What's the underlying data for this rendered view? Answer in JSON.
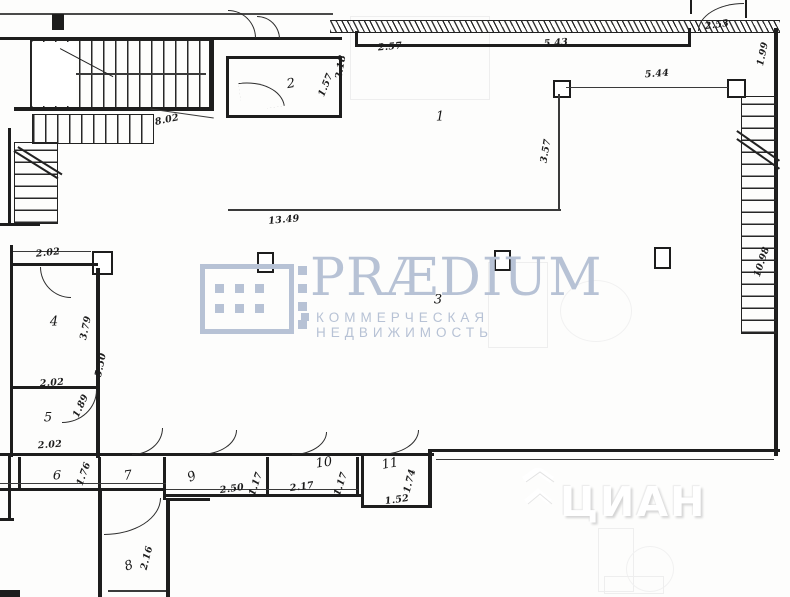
{
  "plan": {
    "rooms": [
      {
        "n": "1",
        "x": 440,
        "y": 117,
        "rot": 0
      },
      {
        "n": "2",
        "x": 291,
        "y": 84,
        "rot": -10
      },
      {
        "n": "3",
        "x": 438,
        "y": 300,
        "rot": 0
      },
      {
        "n": "4",
        "x": 54,
        "y": 322,
        "rot": 0
      },
      {
        "n": "5",
        "x": 48,
        "y": 418,
        "rot": 0
      },
      {
        "n": "6",
        "x": 57,
        "y": 476,
        "rot": 0
      },
      {
        "n": "7",
        "x": 128,
        "y": 476,
        "rot": -8
      },
      {
        "n": "8",
        "x": 129,
        "y": 566,
        "rot": -20
      },
      {
        "n": "9",
        "x": 192,
        "y": 477,
        "rot": -25
      },
      {
        "n": "10",
        "x": 324,
        "y": 463,
        "rot": -8
      },
      {
        "n": "11",
        "x": 390,
        "y": 464,
        "rot": -10
      }
    ],
    "dims": [
      {
        "v": "2.57",
        "x": 390,
        "y": 47,
        "rot": -5
      },
      {
        "v": "5.43",
        "x": 556,
        "y": 43,
        "rot": -4
      },
      {
        "v": "2.53",
        "x": 717,
        "y": 25,
        "rot": -8
      },
      {
        "v": "1.99",
        "x": 763,
        "y": 54,
        "rot": -78
      },
      {
        "v": "5.44",
        "x": 657,
        "y": 74,
        "rot": -4
      },
      {
        "v": "2.18",
        "x": 341,
        "y": 67,
        "rot": -80
      },
      {
        "v": "1.57",
        "x": 326,
        "y": 85,
        "rot": -68
      },
      {
        "v": "8.02",
        "x": 167,
        "y": 120,
        "rot": -12
      },
      {
        "v": "3.57",
        "x": 546,
        "y": 151,
        "rot": -80
      },
      {
        "v": "13.49",
        "x": 284,
        "y": 220,
        "rot": -5
      },
      {
        "v": "10.98",
        "x": 762,
        "y": 262,
        "rot": -72
      },
      {
        "v": "2.02",
        "x": 48,
        "y": 253,
        "rot": -6
      },
      {
        "v": "3.79",
        "x": 86,
        "y": 328,
        "rot": -78
      },
      {
        "v": "5.50",
        "x": 101,
        "y": 365,
        "rot": -78
      },
      {
        "v": "2.02",
        "x": 52,
        "y": 383,
        "rot": -4
      },
      {
        "v": "1.89",
        "x": 81,
        "y": 406,
        "rot": -65
      },
      {
        "v": "2.02",
        "x": 50,
        "y": 445,
        "rot": -4
      },
      {
        "v": "1.76",
        "x": 84,
        "y": 474,
        "rot": -70
      },
      {
        "v": "2.50",
        "x": 232,
        "y": 489,
        "rot": -8
      },
      {
        "v": "1.17",
        "x": 256,
        "y": 484,
        "rot": -72
      },
      {
        "v": "2.17",
        "x": 302,
        "y": 487,
        "rot": -8
      },
      {
        "v": "1.17",
        "x": 341,
        "y": 484,
        "rot": -72
      },
      {
        "v": "1.74",
        "x": 410,
        "y": 481,
        "rot": -76
      },
      {
        "v": "1.52",
        "x": 397,
        "y": 500,
        "rot": -8
      },
      {
        "v": "2.16",
        "x": 147,
        "y": 558,
        "rot": -76
      }
    ]
  },
  "watermarks": {
    "praedium_title": "PRÆDIUM",
    "praedium_tagline": "КОММЕРЧЕСКАЯ НЕДВИЖИМОСТЬ",
    "praedium_color": "#b7c2d5",
    "cian_title": "ЦИАН",
    "cian_color": "#ffffff"
  }
}
